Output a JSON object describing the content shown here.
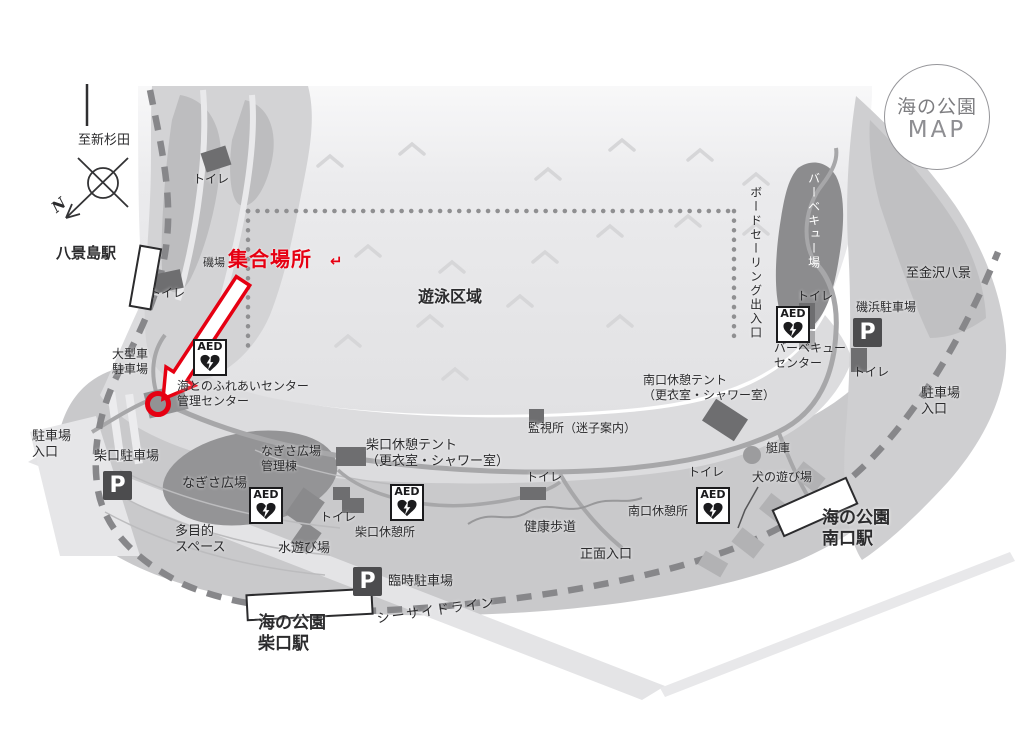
{
  "map": {
    "logo": {
      "line1": "海の公園",
      "line2": "MAP"
    },
    "compass": {
      "north": "N"
    },
    "icons": {
      "aed": "AED",
      "parking": "P"
    },
    "colors": {
      "accent_red": "#e60012",
      "water_gray": "#e3e3e5",
      "land_gray": "#cfcfd1",
      "dark_area_gray": "#8c8c8e",
      "building_gray": "#6e6e70"
    },
    "red_marker": {
      "area_label": "磯場",
      "label": "集合場所",
      "return_symbol": "↵"
    },
    "labels": {
      "to_shinsugita": "至新杉田",
      "hakkeijima_station": "八景島駅",
      "toilet": "トイレ",
      "swim_area": "遊泳区域",
      "boardsailing_gate": "ボードセーリング出入口",
      "bbq_ground": "バーベキュー場",
      "to_kanazawa_hakkei": "至金沢八景",
      "isohama_parking": "磯浜駐車場",
      "bbq_center_line1": "バーベキュー",
      "bbq_center_line2": "センター",
      "parking_entrance_line1": "駐車場",
      "parking_entrance_line2": "入口",
      "large_vehicle_parking_line1": "大型車",
      "large_vehicle_parking_line2": "駐車場",
      "fureai_center_line1": "海とのふれあいセンター",
      "fureai_center_line2": "管理センター",
      "south_tent_line1": "南口休憩テント",
      "south_tent_line2": "（更衣室・シャワー室）",
      "watch_station": "監視所（迷子案内）",
      "shibaguchi_parking": "柴口駐車場",
      "nagisa_plaza": "なぎさ広場",
      "nagisa_admin_line1": "なぎさ広場",
      "nagisa_admin_line2": "管理棟",
      "shibaguchi_tent_line1": "柴口休憩テント",
      "shibaguchi_tent_line2": "（更衣室・シャワー室）",
      "multipurpose_line1": "多目的",
      "multipurpose_line2": "スペース",
      "water_play": "水遊び場",
      "shibaguchi_rest": "柴口休憩所",
      "health_walk": "健康歩道",
      "main_entrance": "正面入口",
      "south_rest": "南口休憩所",
      "boathouse": "艇庫",
      "dog_play": "犬の遊び場",
      "south_station_line1": "海の公園",
      "south_station_line2": "南口駅",
      "temp_parking": "臨時駐車場",
      "seaside_line": "シーサイドライン",
      "shibaguchi_station_line1": "海の公園",
      "shibaguchi_station_line2": "柴口駅"
    }
  }
}
